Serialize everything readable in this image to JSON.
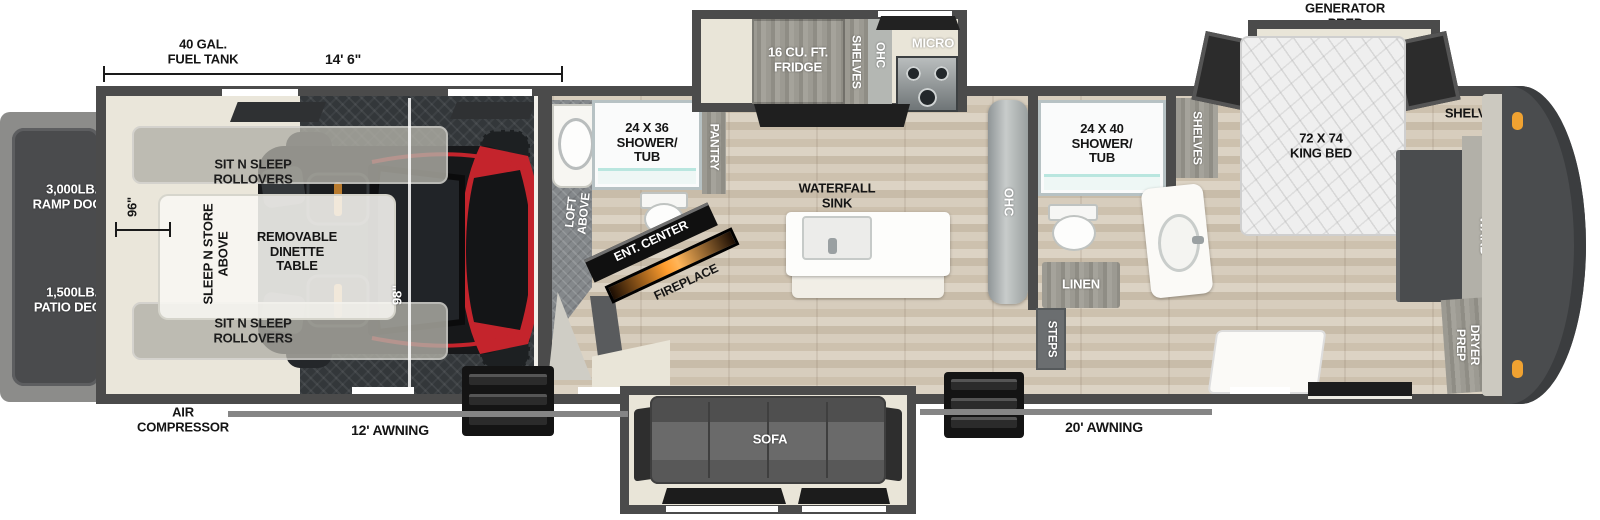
{
  "labels": {
    "fuel_tank": "40 GAL.\nFUEL TANK",
    "garage_length": "14' 6\"",
    "generator_prep": "GENERATOR\nPREP",
    "ramp_door": "3,000LB.\nRAMP DOOR",
    "patio_deck": "1,500LB.\nPATIO DECK",
    "dim_96": "96\"",
    "dim_98": "98\"",
    "rollovers_top": "SIT N SLEEP\nROLLOVERS",
    "rollovers_bottom": "SIT N SLEEP\nROLLOVERS",
    "sleep_n_store": "SLEEP N STORE\nABOVE",
    "dinette": "REMOVABLE\nDINETTE\nTABLE",
    "air_compressor": "AIR\nCOMPRESSOR",
    "awning_12": "12' AWNING",
    "awning_20": "20' AWNING",
    "shower_mid": "24 X 36\nSHOWER/\nTUB",
    "loft_above": "LOFT\nABOVE",
    "pantry": "PANTRY",
    "ent_center": "ENT. CENTER",
    "fireplace": "FIREPLACE",
    "fridge": "16 CU. FT.\nFRIDGE",
    "shelves_kitchen": "SHELVES",
    "ohc_kitchen": "OHC",
    "micro": "MICRO",
    "waterfall_sink": "WATERFALL\nSINK",
    "ohc_island": "OHC",
    "sofa": "SOFA",
    "shower_rear": "24 X 40\nSHOWER/\nTUB",
    "shelves_bath": "SHELVES",
    "linen": "LINEN",
    "steps": "STEPS",
    "king_bed": "72 X 74\nKING BED",
    "shelves_cap": "SHELVES",
    "ward": "WARD",
    "washer_dryer": "WASHER/\nDRYER\nPREP"
  },
  "colors": {
    "wall_gray": "#4b4b4b",
    "floor_beige": "#eae6da",
    "diamond_plate": "#33373a",
    "utv_red": "#c4242c",
    "marker_orange": "#f0a231",
    "fireplace_glow": "#ff9d2e",
    "awning_gray": "#858585"
  }
}
